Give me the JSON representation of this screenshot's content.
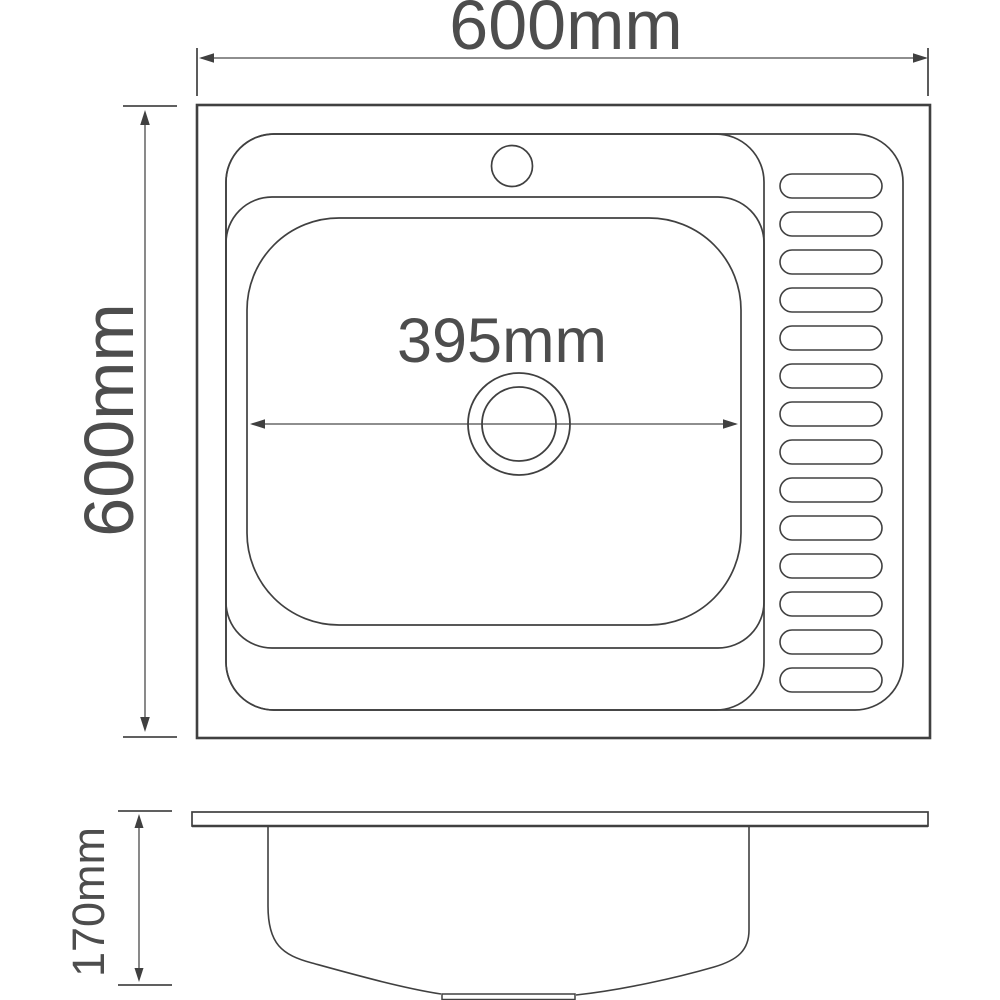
{
  "colors": {
    "background": "#ffffff",
    "line": "#404040",
    "text": "#4d4d4d"
  },
  "dimensions": {
    "top_width": {
      "label": "600mm"
    },
    "left_height": {
      "label": "600mm"
    },
    "bowl_width": {
      "label": "395mm"
    },
    "side_depth": {
      "label": "170mm"
    }
  },
  "drainboard": {
    "rib_count": 14
  },
  "features": {
    "top_view": [
      "sink-outline",
      "rim",
      "bowl-section",
      "inner-rim",
      "basin",
      "faucet-hole",
      "drain",
      "drainboard-ribs"
    ],
    "side_view": [
      "countertop-slab",
      "bowl-profile",
      "drain-fitting"
    ]
  }
}
